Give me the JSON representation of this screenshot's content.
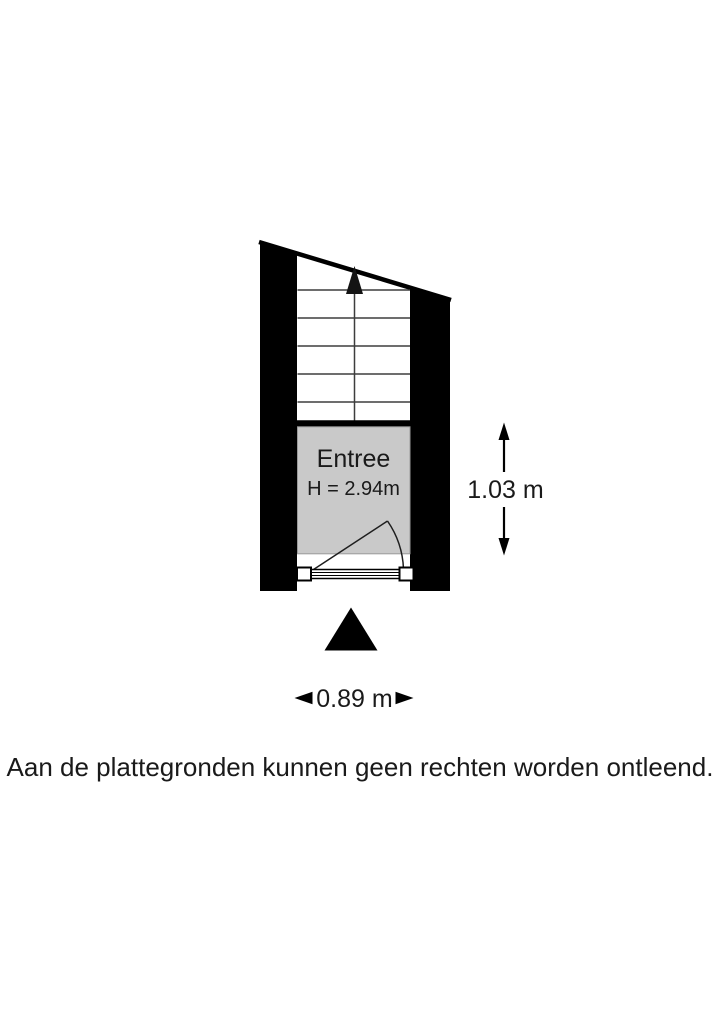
{
  "floorplan": {
    "room": {
      "name": "Entree",
      "height_label": "H = 2.94m"
    },
    "dimensions": {
      "vertical_label": "1.03 m",
      "horizontal_label": "0.89 m"
    },
    "colors": {
      "wall": "#000000",
      "room_fill": "#c9c9c9",
      "room_border": "#9a9a9a",
      "stair_line": "#3d3d3d",
      "text": "#1a1a1a"
    },
    "icons": {
      "stairs_direction": "up-arrow",
      "orientation_marker": "north-triangle",
      "vertical_dimension": "double-headed-vertical-arrow",
      "horizontal_dimension": "left-right-arrowheads"
    }
  },
  "disclaimer": "Aan de plattegronden kunnen geen rechten worden ontleend."
}
